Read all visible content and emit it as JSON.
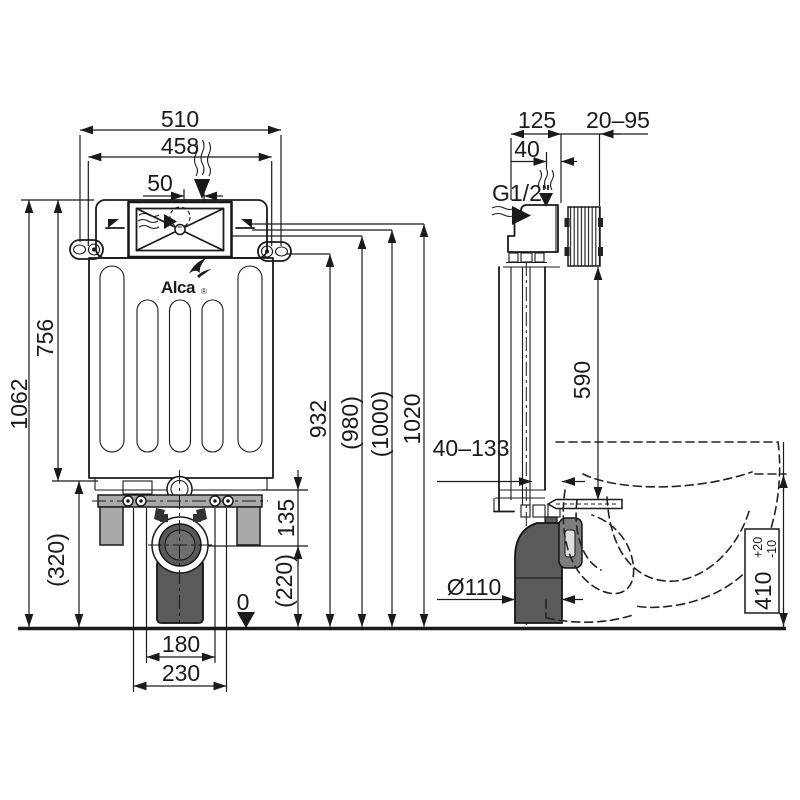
{
  "brand": {
    "name": "Alca",
    "mark": "®"
  },
  "front": {
    "overall_width": "510",
    "frame_width": "458",
    "flush_offset": "50",
    "tank_height": "756",
    "overall_height": "1062",
    "base_height": "(320)",
    "valve_to_drain": "135",
    "drain_axis_height": "(220)",
    "floor_level": "0",
    "anchor_spacing": "180",
    "anchor_outer_spacing": "230",
    "h932": "932",
    "h980": "(980)",
    "h1000": "(1000)",
    "h1020": "1020"
  },
  "side": {
    "depth": "125",
    "wall_finish_range": "20–95",
    "inlet_to_wall": "40",
    "water_inlet_thread": "G1/2\"",
    "flush_pipe_length": "590",
    "pipe_to_wall_range": "40–133",
    "drain_diameter": "Ø110",
    "bowl_height": "410",
    "bowl_height_tol_plus": "+20",
    "bowl_height_tol_minus": "-10"
  }
}
